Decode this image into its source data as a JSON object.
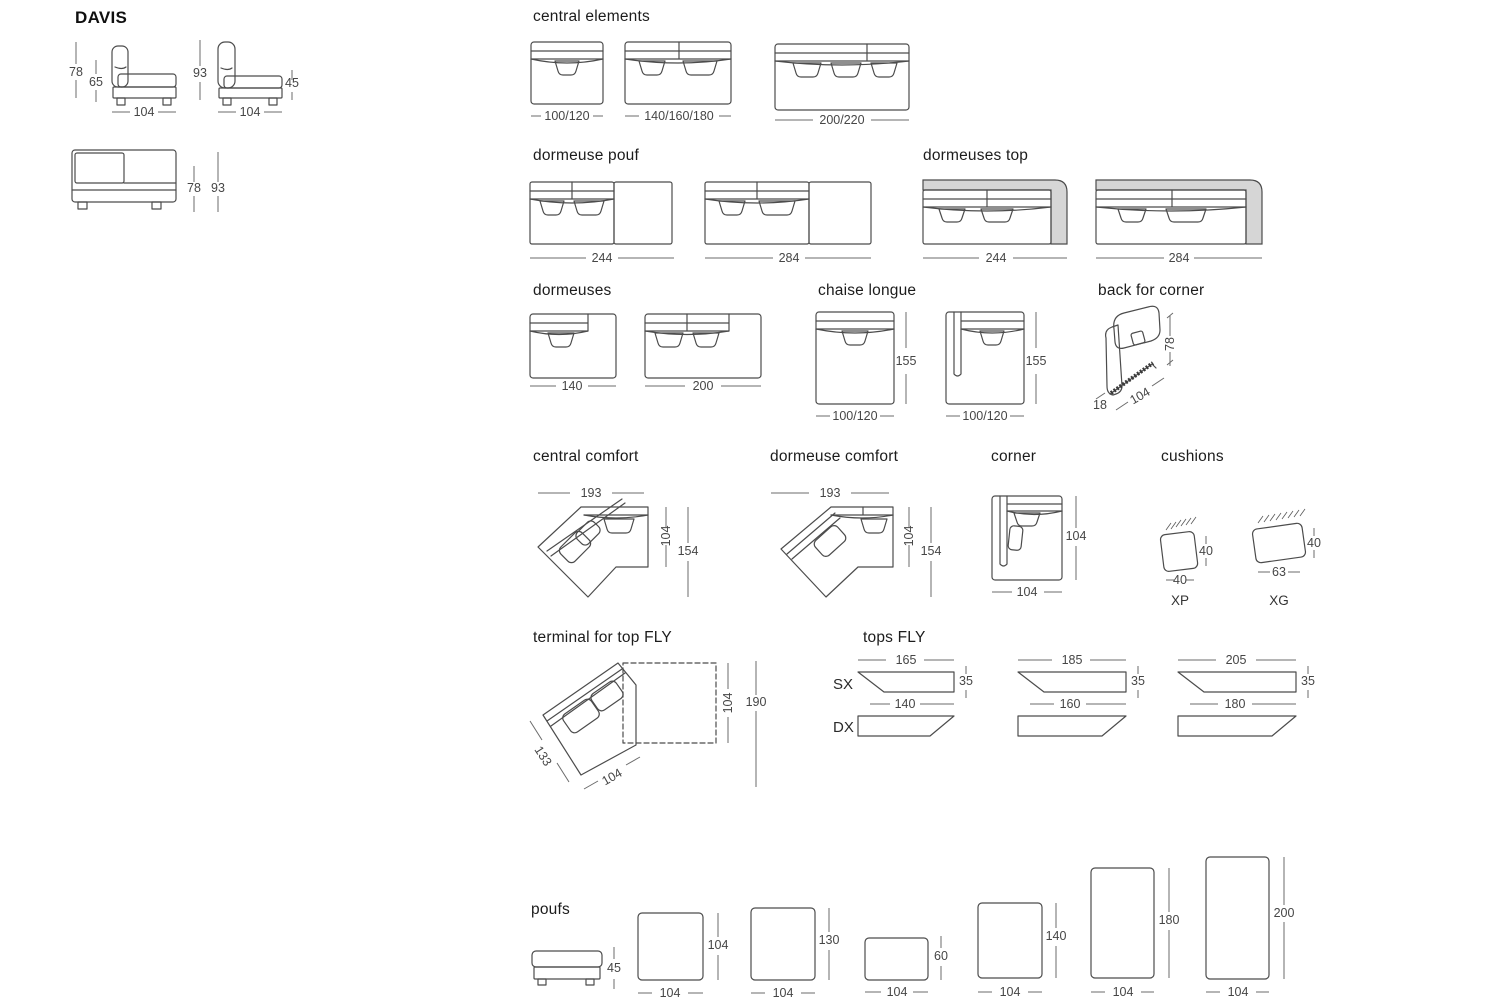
{
  "page_title": "DAVIS",
  "colors": {
    "line": "#4c4c4c",
    "shade": "#d6d6d6",
    "background": "#ffffff"
  },
  "side_views": {
    "module_side": {
      "back_height": "78",
      "seat_height": "65",
      "width": "104"
    },
    "module_side_high": {
      "back_height": "93",
      "arm_height": "45",
      "width": "104"
    },
    "module_front": {
      "height_back": "78",
      "height_total": "93"
    }
  },
  "central_elements": {
    "title": "central elements",
    "widths": [
      "100/120",
      "140/160/180",
      "200/220"
    ]
  },
  "dormeuse_pouf": {
    "title": "dormeuse pouf",
    "widths": [
      "244",
      "284"
    ]
  },
  "dormeuses_top": {
    "title": "dormeuses top",
    "widths": [
      "244",
      "284"
    ]
  },
  "dormeuses": {
    "title": "dormeuses",
    "widths": [
      "140",
      "200"
    ]
  },
  "chaise_longue": {
    "title": "chaise longue",
    "depth": "155",
    "width": "100/120"
  },
  "back_for_corner": {
    "title": "back for corner",
    "height": "78",
    "thickness": "18",
    "width": "104"
  },
  "central_comfort": {
    "title": "central comfort",
    "width": "193",
    "depth_inner": "104",
    "depth_total": "154"
  },
  "dormeuse_comfort": {
    "title": "dormeuse comfort",
    "width": "193",
    "depth_inner": "104",
    "depth_total": "154"
  },
  "corner": {
    "title": "corner",
    "depth": "104",
    "width": "104"
  },
  "cushions": {
    "title": "cushions",
    "items": [
      {
        "code": "XP",
        "width": "40",
        "height": "40"
      },
      {
        "code": "XG",
        "width": "63",
        "height": "40"
      }
    ]
  },
  "terminal_top_fly": {
    "title": "terminal for top FLY",
    "side": "133",
    "width": "104",
    "depth_inner": "104",
    "depth_total": "190"
  },
  "tops_fly": {
    "title": "tops FLY",
    "left_label": "SX",
    "right_label": "DX",
    "items": [
      {
        "top": "165",
        "bottom": "140",
        "depth": "35"
      },
      {
        "top": "185",
        "bottom": "160",
        "depth": "35"
      },
      {
        "top": "205",
        "bottom": "180",
        "depth": "35"
      }
    ]
  },
  "poufs": {
    "title": "poufs",
    "side_height": "45",
    "items": [
      {
        "width": "104",
        "depth": "104"
      },
      {
        "width": "104",
        "depth": "130"
      },
      {
        "width": "104",
        "depth": "60"
      },
      {
        "width": "104",
        "depth": "140"
      },
      {
        "width": "104",
        "depth": "180"
      },
      {
        "width": "104",
        "depth": "200"
      }
    ]
  }
}
